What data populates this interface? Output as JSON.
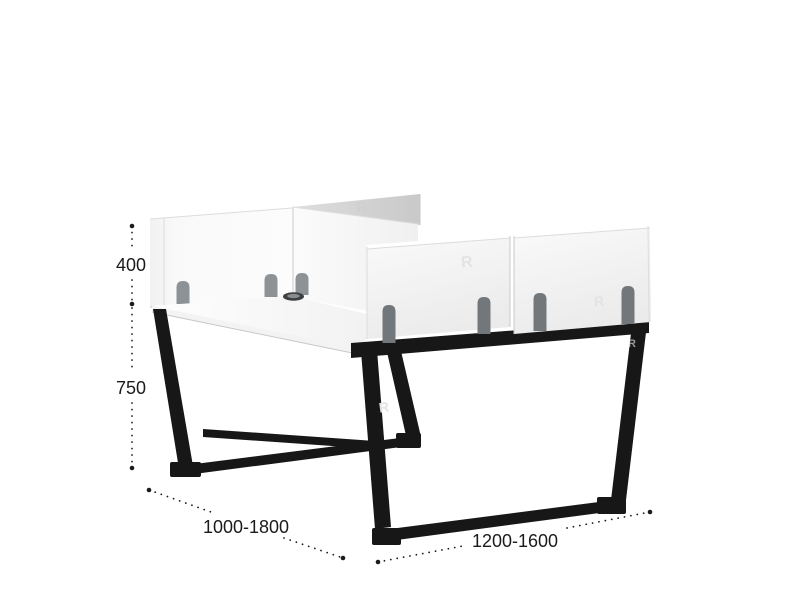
{
  "diagram": {
    "type": "product-dimension-diagram",
    "product": "face-to-face office workstation with privacy screens and trapezoid metal legs",
    "labels": {
      "screen_height": "400",
      "desk_height": "750",
      "width_range": "1000-1800",
      "depth_range": "1200-1600"
    },
    "watermark": "R",
    "colors": {
      "background": "#ffffff",
      "panel_white": "#f7f7f7",
      "panel_gray": "#d2d2d2",
      "frame_black": "#171717",
      "tab_gray_light": "#8d9296",
      "tab_gray_dark": "#72777b",
      "dimension_text": "#1b1b1b"
    }
  }
}
